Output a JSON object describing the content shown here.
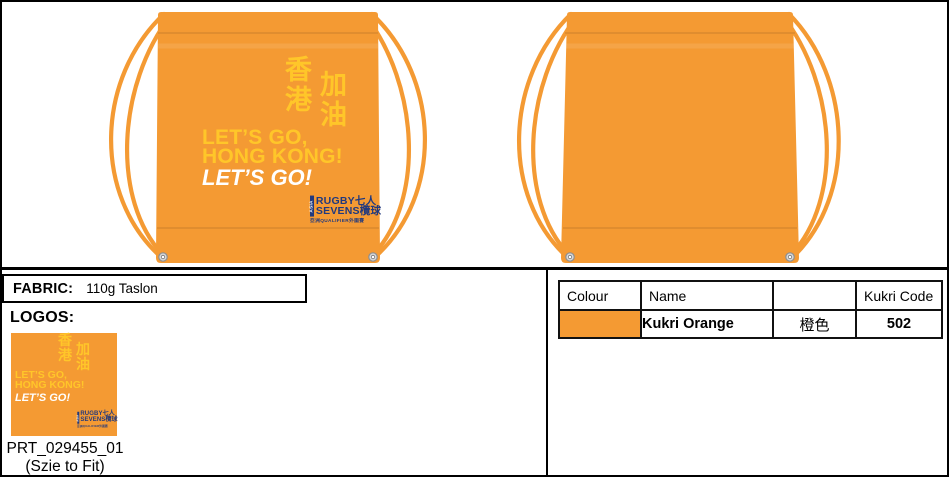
{
  "colors": {
    "orange": "#F49A33",
    "yellow": "#FFC629",
    "navy": "#21397E",
    "white": "#FFFFFF"
  },
  "print": {
    "cjk_col1": "香港",
    "cjk_col2": "加油",
    "slogan_line1": "LET’S GO,",
    "slogan_line2": "HONG KONG!",
    "slogan_line3": "LET’S GO!",
    "logo": {
      "side": "ASIA",
      "line1": "RUGBY七人",
      "line2": "SEVENS欖球",
      "tagline": "亞洲QUALIFIER外圍賽"
    }
  },
  "fabric": {
    "label": "FABRIC:",
    "value": "110g Taslon"
  },
  "logos": {
    "label": "LOGOS:",
    "print_code": "PRT_029455_01",
    "note": "(Szie to Fit)"
  },
  "colour_table": {
    "headers": [
      "Colour",
      "Name",
      "",
      "Kukri Code"
    ],
    "rows": [
      {
        "name": "Kukri Orange",
        "name_cn": "橙色",
        "kukri_code": "502"
      }
    ]
  }
}
